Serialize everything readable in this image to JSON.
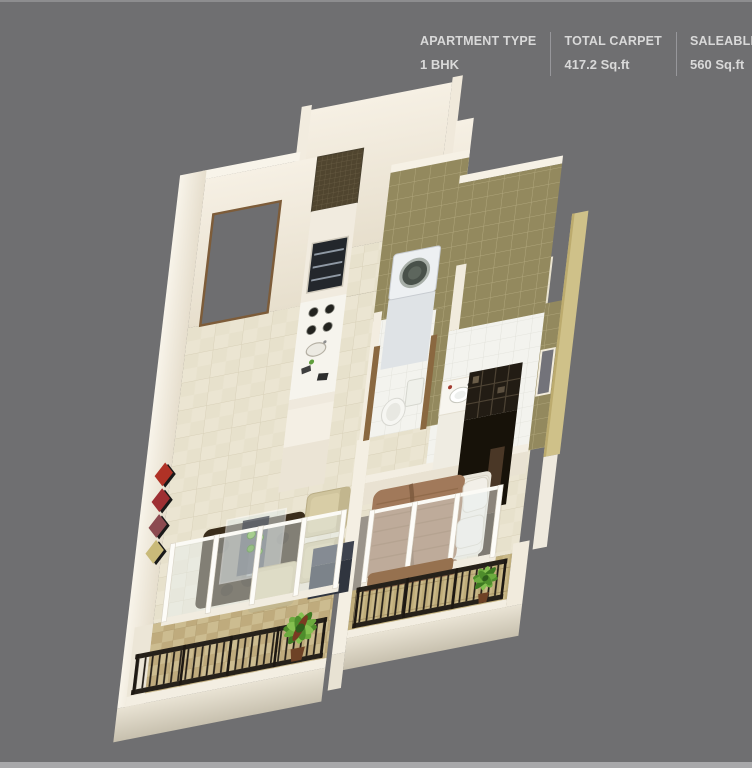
{
  "header": {
    "columns": [
      {
        "label": "APARTMENT TYPE",
        "value": "1 BHK"
      },
      {
        "label": "TOTAL CARPET",
        "value": "417.2 Sq.ft"
      },
      {
        "label": "SALEABLE AREA",
        "value": "560 Sq.ft"
      }
    ]
  },
  "floor_plan": {
    "type": "isometric-3d-render",
    "rooms": [
      "living-room",
      "kitchen",
      "bathroom",
      "wc",
      "bedroom",
      "living-balcony",
      "bedroom-balcony",
      "entrance"
    ],
    "elements": [
      "entrance-door",
      "wall-art",
      "kitchen-unit",
      "oven",
      "hob-burners",
      "kitchen-sink",
      "washing-machine",
      "toilet",
      "wash-basin",
      "bathroom-window",
      "wardrobe",
      "bed",
      "pillows",
      "dining-table",
      "sofa-set",
      "tv-cabinet",
      "living-rug",
      "bedroom-rug",
      "sliding-glass-doors",
      "balcony-railings",
      "potted-plants"
    ],
    "colors": {
      "background": "#6f6f71",
      "header_text": "#d9d9d9",
      "header_divider": "#97979b",
      "wall_cream": "#f3ede1",
      "floor_tile": "#ebe5d2",
      "bathroom_wall_tile": "#93895e",
      "bathroom_floor_tile": "#f3f3ee",
      "exterior_tan_wall": "#cfc189",
      "balcony_tile": "#ccbc90",
      "railing": "#26211a",
      "bed_blanket": "#a1795a",
      "dark_furniture": "#221c14",
      "sofa_beige": "#cfc49d",
      "plant_green": "#6cab3e"
    }
  }
}
